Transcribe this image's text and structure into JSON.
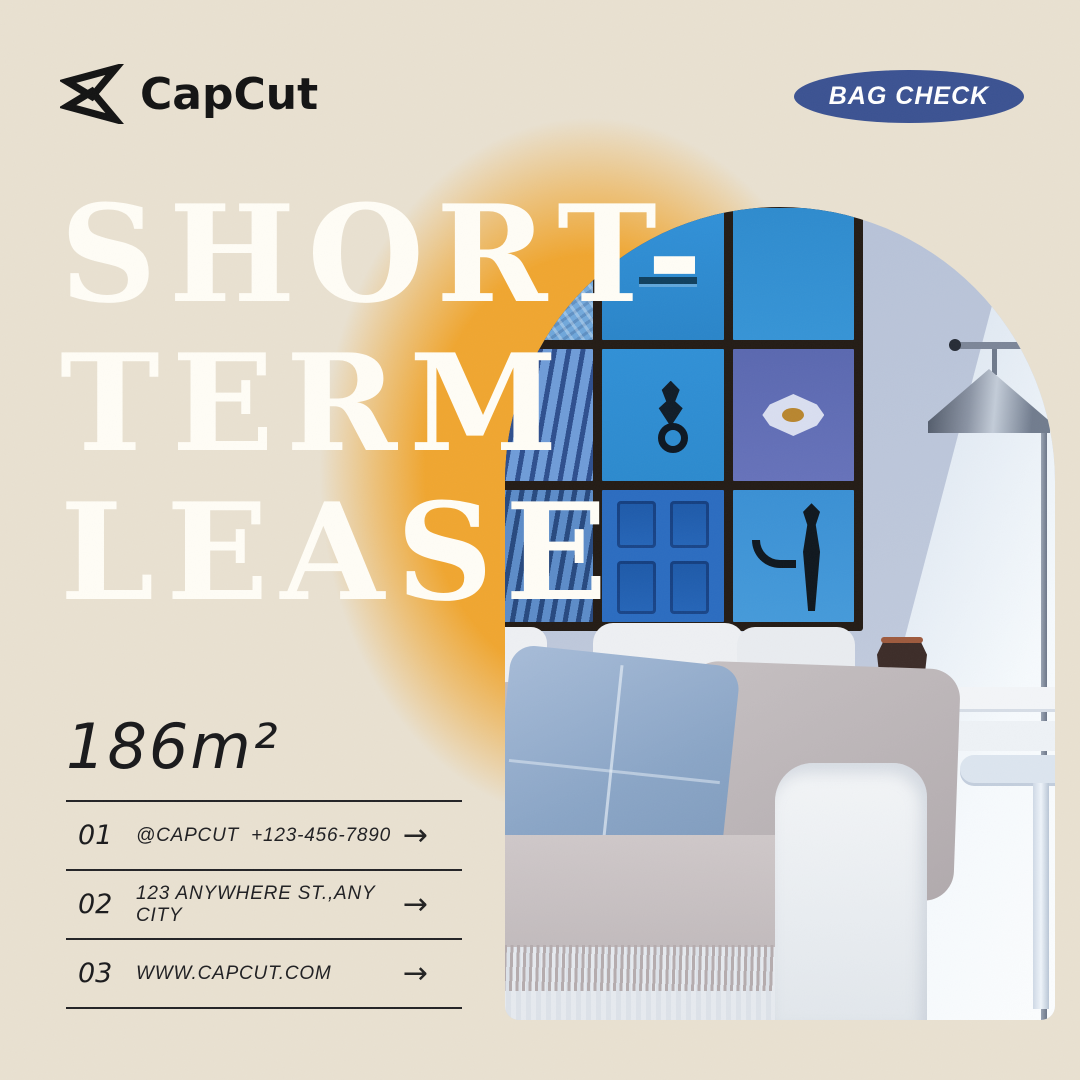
{
  "header": {
    "brand": "CapCut",
    "badge": "BAG CHECK"
  },
  "title": {
    "lines": [
      "SHORT-",
      "TERM",
      "LEASE"
    ]
  },
  "area": "186m²",
  "contacts": [
    {
      "num": "01",
      "label": "@CAPCUT  +123-456-7890"
    },
    {
      "num": "02",
      "label": "123 ANYWHERE ST.,ANY CITY"
    },
    {
      "num": "03",
      "label": "WWW.CAPCUT.COM"
    }
  ],
  "ui": {
    "arrow": "→"
  },
  "colors": {
    "background": "#e9e1d1",
    "accent_orange": "#f0a630",
    "badge_blue": "#3b5292",
    "title_white": "#fffdf6",
    "text_dark": "#1c1c1e"
  }
}
